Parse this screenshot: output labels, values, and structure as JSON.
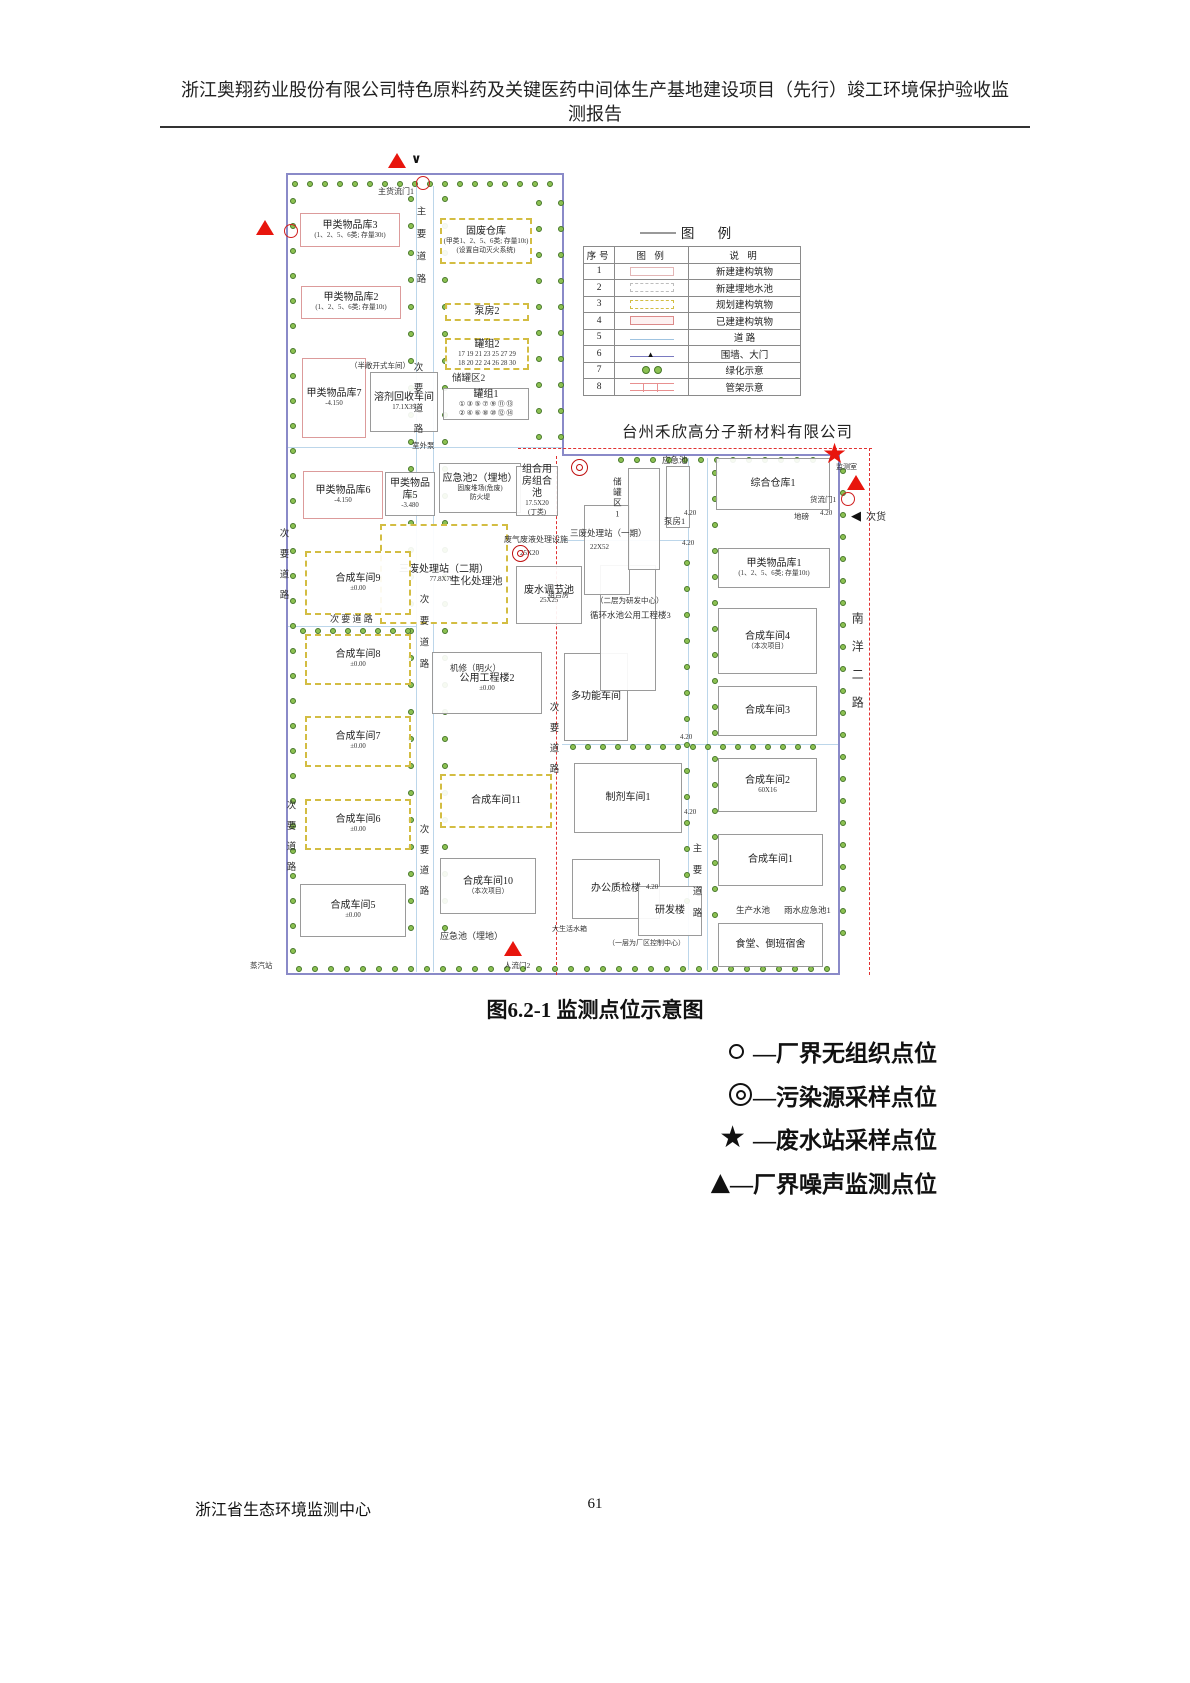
{
  "header": {
    "line1": "浙江奥翔药业股份有限公司特色原料药及关键医药中间体生产基地建设项目（先行）竣工环境保护验收监",
    "line2": "测报告"
  },
  "figure": {
    "caption": "图6.2-1  监测点位示意图"
  },
  "company_label": "台州禾欣高分子新材料有限公司",
  "legend_table": {
    "title": "图  例",
    "headers": [
      "序号",
      "图 例",
      "说 明"
    ],
    "rows": [
      {
        "no": "1",
        "symbol": "new-building",
        "desc": "新建建构筑物"
      },
      {
        "no": "2",
        "symbol": "new-pool",
        "desc": "新建埋地水池"
      },
      {
        "no": "3",
        "symbol": "planned",
        "desc": "规划建构筑物"
      },
      {
        "no": "4",
        "symbol": "existing",
        "desc": "已建建构筑物"
      },
      {
        "no": "5",
        "symbol": "road",
        "desc": "道  路"
      },
      {
        "no": "6",
        "symbol": "fence-gate",
        "desc": "围墙、大门"
      },
      {
        "no": "7",
        "symbol": "greenery",
        "desc": "绿化示意"
      },
      {
        "no": "8",
        "symbol": "pipe-rack",
        "desc": "管架示意"
      }
    ]
  },
  "point_legend": [
    {
      "symbol": "circle",
      "label": "—厂界无组织点位"
    },
    {
      "symbol": "double-circle",
      "label": "—污染源采样点位"
    },
    {
      "symbol": "star",
      "label": "—废水站采样点位"
    },
    {
      "symbol": "triangle",
      "label": "—厂界噪声监测点位"
    }
  ],
  "footer": {
    "org": "浙江省生态环境监测中心",
    "page": "61"
  },
  "map": {
    "buildings": [
      {
        "id": "jialei-wupinku-3",
        "name": "甲类物品库3",
        "sub": [
          "(1、2、5、6类; 存量30t)"
        ],
        "x": 300,
        "y": 213,
        "w": 100,
        "h": 34,
        "style": "red"
      },
      {
        "id": "gufei-cangku",
        "name": "固废仓库",
        "sub": [
          "(甲类1、2、5、6类; 存量10t)",
          "(设置自动灭火系统)"
        ],
        "x": 440,
        "y": 218,
        "w": 92,
        "h": 46,
        "style": "yellow"
      },
      {
        "id": "jialei-wupinku-2",
        "name": "甲类物品库2",
        "sub": [
          "(1、2、5、6类; 存量10t)"
        ],
        "x": 301,
        "y": 286,
        "w": 100,
        "h": 33,
        "style": "red"
      },
      {
        "id": "bengfang-2",
        "name": "泵房2",
        "sub": [],
        "x": 445,
        "y": 303,
        "w": 84,
        "h": 18,
        "style": "yellow"
      },
      {
        "id": "guanzu-2",
        "name": "罐组2",
        "sub": [
          "17 19 21 23 25 27 29",
          "18 20 22 24 26 28 30"
        ],
        "x": 445,
        "y": 338,
        "w": 84,
        "h": 32,
        "style": "yellow"
      },
      {
        "id": "guanzu-1",
        "name": "罐组1",
        "sub": [
          "① ③ ⑤ ⑦ ⑨ ⑪ ⑬",
          "② ④ ⑥ ⑧ ⑩ ⑫ ⑭"
        ],
        "x": 443,
        "y": 388,
        "w": 86,
        "h": 32,
        "style": "gray"
      },
      {
        "id": "jialei-wupinku-7",
        "name": "甲类物品库7",
        "sub": [
          "-4.150"
        ],
        "x": 302,
        "y": 358,
        "w": 64,
        "h": 80,
        "style": "red"
      },
      {
        "id": "rongji-huishou",
        "name": "溶剂回收车间",
        "sub": [
          "17.1X39"
        ],
        "x": 370,
        "y": 372,
        "w": 68,
        "h": 60,
        "style": "gray"
      },
      {
        "id": "yingjichi-2",
        "name": "应急池2（埋地）",
        "sub": [
          "固废堆场(危废)",
          "防火堤"
        ],
        "x": 439,
        "y": 463,
        "w": 82,
        "h": 50,
        "style": "gray"
      },
      {
        "id": "jialei-wupinku-5",
        "name": "甲类物品库5",
        "sub": [
          "-3.480"
        ],
        "x": 385,
        "y": 472,
        "w": 50,
        "h": 44,
        "style": "gray"
      },
      {
        "id": "jialei-wupinku-6",
        "name": "甲类物品库6",
        "sub": [
          "-4.150"
        ],
        "x": 303,
        "y": 471,
        "w": 80,
        "h": 48,
        "style": "red"
      },
      {
        "id": "zuhe-yongfang",
        "name": "组合用房组合池",
        "sub": [
          "17.5X20",
          "(丁类)"
        ],
        "x": 516,
        "y": 466,
        "w": 42,
        "h": 50,
        "style": "gray"
      },
      {
        "id": "sanfei-erqi",
        "name": "三废处理站（二期）",
        "sub": [
          "77.8X79.5"
        ],
        "x": 380,
        "y": 524,
        "w": 128,
        "h": 100,
        "style": "yellow"
      },
      {
        "id": "feishui-tiaojiechi",
        "name": "废水调节池",
        "sub": [
          "25X25"
        ],
        "x": 516,
        "y": 566,
        "w": 66,
        "h": 58,
        "style": "gray"
      },
      {
        "id": "hecheng-9",
        "name": "合成车间9",
        "sub": [
          "±0.00"
        ],
        "x": 305,
        "y": 551,
        "w": 106,
        "h": 64,
        "style": "yellow"
      },
      {
        "id": "hecheng-8",
        "name": "合成车间8",
        "sub": [
          "±0.00"
        ],
        "x": 305,
        "y": 634,
        "w": 106,
        "h": 51,
        "style": "yellow"
      },
      {
        "id": "gongyong-gongchenglou-2",
        "name": "公用工程楼2",
        "sub": [
          "±0.00"
        ],
        "x": 432,
        "y": 652,
        "w": 110,
        "h": 62,
        "style": "gray"
      },
      {
        "id": "hecheng-7",
        "name": "合成车间7",
        "sub": [
          "±0.00"
        ],
        "x": 305,
        "y": 716,
        "w": 106,
        "h": 51,
        "style": "yellow"
      },
      {
        "id": "hecheng-11",
        "name": "合成车间11",
        "sub": [],
        "x": 440,
        "y": 774,
        "w": 112,
        "h": 54,
        "style": "yellow"
      },
      {
        "id": "hecheng-6",
        "name": "合成车间6",
        "sub": [
          "±0.00"
        ],
        "x": 305,
        "y": 799,
        "w": 106,
        "h": 51,
        "style": "yellow"
      },
      {
        "id": "hecheng-5",
        "name": "合成车间5",
        "sub": [
          "±0.00"
        ],
        "x": 300,
        "y": 884,
        "w": 106,
        "h": 53,
        "style": "gray"
      },
      {
        "id": "hecheng-10",
        "name": "合成车间10",
        "sub": [
          "（本次项目）"
        ],
        "x": 440,
        "y": 858,
        "w": 96,
        "h": 56,
        "style": "gray"
      },
      {
        "id": "duogongneng",
        "name": "多功能车间",
        "sub": [],
        "x": 564,
        "y": 653,
        "w": 64,
        "h": 88,
        "style": "gray"
      },
      {
        "id": "gongyong-gongchenglou-3",
        "name": "",
        "sub": [],
        "x": 600,
        "y": 565,
        "w": 56,
        "h": 126,
        "style": "gray"
      },
      {
        "id": "sanfei-yiqi",
        "name": "",
        "sub": [],
        "x": 584,
        "y": 505,
        "w": 46,
        "h": 90,
        "style": "gray"
      },
      {
        "id": "chuguanqu-1",
        "name": "",
        "sub": [],
        "x": 628,
        "y": 468,
        "w": 32,
        "h": 102,
        "style": "gray"
      },
      {
        "id": "yingjichi-right",
        "name": "",
        "sub": [],
        "x": 666,
        "y": 466,
        "w": 24,
        "h": 62,
        "style": "gray"
      },
      {
        "id": "zonghe-cangku-1",
        "name": "综合仓库1",
        "sub": [],
        "x": 716,
        "y": 458,
        "w": 114,
        "h": 52,
        "style": "gray"
      },
      {
        "id": "jialei-wupinku-1",
        "name": "甲类物品库1",
        "sub": [
          "(1、2、5、6类; 存量10t)"
        ],
        "x": 718,
        "y": 548,
        "w": 112,
        "h": 40,
        "style": "gray"
      },
      {
        "id": "hecheng-4",
        "name": "合成车间4",
        "sub": [
          "（本次项目）"
        ],
        "x": 718,
        "y": 608,
        "w": 99,
        "h": 66,
        "style": "gray"
      },
      {
        "id": "hecheng-3",
        "name": "合成车间3",
        "sub": [],
        "x": 718,
        "y": 686,
        "w": 99,
        "h": 50,
        "style": "gray"
      },
      {
        "id": "hecheng-2",
        "name": "合成车间2",
        "sub": [
          "60X16"
        ],
        "x": 718,
        "y": 758,
        "w": 99,
        "h": 54,
        "style": "gray"
      },
      {
        "id": "hecheng-1",
        "name": "合成车间1",
        "sub": [],
        "x": 718,
        "y": 834,
        "w": 105,
        "h": 52,
        "style": "gray"
      },
      {
        "id": "zhiji-1",
        "name": "制剂车间1",
        "sub": [],
        "x": 574,
        "y": 763,
        "w": 108,
        "h": 70,
        "style": "gray"
      },
      {
        "id": "bangong-zhijianlou",
        "name": "办公质检楼",
        "sub": [],
        "x": 572,
        "y": 859,
        "w": 88,
        "h": 60,
        "style": "gray"
      },
      {
        "id": "yanfalou",
        "name": "研发楼",
        "sub": [],
        "x": 638,
        "y": 886,
        "w": 64,
        "h": 50,
        "style": "gray"
      },
      {
        "id": "shitang-sushe",
        "name": "食堂、倒班宿舍",
        "sub": [],
        "x": 718,
        "y": 923,
        "w": 105,
        "h": 44,
        "style": "gray"
      }
    ],
    "labels": [
      {
        "t": "主货流门1",
        "x": 378,
        "y": 188,
        "s": 8
      },
      {
        "t": "（半敞开式车间）",
        "x": 350,
        "y": 362,
        "s": 7.5
      },
      {
        "t": "室外泵",
        "x": 412,
        "y": 442,
        "s": 7.5
      },
      {
        "t": "储罐区2",
        "x": 452,
        "y": 374,
        "s": 9.5
      },
      {
        "t": "机修（明火）",
        "x": 450,
        "y": 664,
        "s": 8.5
      },
      {
        "t": "次 要 道 路",
        "x": 330,
        "y": 615,
        "s": 9
      },
      {
        "t": "应急池（埋地）",
        "x": 440,
        "y": 932,
        "s": 9
      },
      {
        "t": "蒸汽站",
        "x": 250,
        "y": 962,
        "s": 7.5
      },
      {
        "t": "人流门2",
        "x": 504,
        "y": 962,
        "s": 7.5
      },
      {
        "t": "大生活水箱",
        "x": 552,
        "y": 926,
        "s": 7
      },
      {
        "t": "（一层为厂区控制中心）",
        "x": 608,
        "y": 940,
        "s": 7
      },
      {
        "t": "废气废液处理设施",
        "x": 504,
        "y": 536,
        "s": 8
      },
      {
        "t": "25X20",
        "x": 520,
        "y": 550,
        "s": 7
      },
      {
        "t": "三废处理站（一期）",
        "x": 570,
        "y": 529,
        "s": 8.5
      },
      {
        "t": "22X52",
        "x": 590,
        "y": 544,
        "s": 7
      },
      {
        "t": "生化处理池",
        "x": 450,
        "y": 576,
        "s": 10.5
      },
      {
        "t": "（二层为研发中心）",
        "x": 596,
        "y": 597,
        "s": 7.5
      },
      {
        "t": "循环水池公用工程楼3",
        "x": 590,
        "y": 611,
        "s": 8.5
      },
      {
        "t": "组合房",
        "x": 548,
        "y": 592,
        "s": 7
      },
      {
        "t": "应急池",
        "x": 662,
        "y": 456,
        "s": 8.5
      },
      {
        "t": "泵房1",
        "x": 664,
        "y": 517,
        "s": 8.5
      },
      {
        "t": "监测室",
        "x": 836,
        "y": 464,
        "s": 7
      },
      {
        "t": "货流门1",
        "x": 810,
        "y": 496,
        "s": 7.5
      },
      {
        "t": "地磅",
        "x": 794,
        "y": 513,
        "s": 7.5
      },
      {
        "t": "次货",
        "x": 866,
        "y": 512,
        "s": 10
      },
      {
        "t": "生产水池",
        "x": 736,
        "y": 906,
        "s": 8.5
      },
      {
        "t": "雨水应急池1",
        "x": 784,
        "y": 906,
        "s": 8.5
      },
      {
        "t": "4.20",
        "x": 684,
        "y": 510,
        "s": 7
      },
      {
        "t": "4.20",
        "x": 820,
        "y": 510,
        "s": 7
      },
      {
        "t": "4.20",
        "x": 682,
        "y": 540,
        "s": 7
      },
      {
        "t": "4.20",
        "x": 680,
        "y": 734,
        "s": 7
      },
      {
        "t": "4.20",
        "x": 684,
        "y": 809,
        "s": 7
      },
      {
        "t": "4.20",
        "x": 646,
        "y": 884,
        "s": 7
      }
    ],
    "vlabels": [
      {
        "t": "主要道路",
        "x": 414,
        "y": 206,
        "s": 9.5,
        "ls": 13
      },
      {
        "t": "次要道路",
        "x": 411,
        "y": 362,
        "s": 9.5,
        "ls": 11
      },
      {
        "t": "次要道路",
        "x": 277,
        "y": 528,
        "s": 9.5,
        "ls": 11
      },
      {
        "t": "次要道路",
        "x": 417,
        "y": 594,
        "s": 9.5,
        "ls": 12
      },
      {
        "t": "次要道路",
        "x": 284,
        "y": 800,
        "s": 9.5,
        "ls": 11
      },
      {
        "t": "次要道路",
        "x": 417,
        "y": 824,
        "s": 9.5,
        "ls": 11
      },
      {
        "t": "次要道路",
        "x": 547,
        "y": 702,
        "s": 9.5,
        "ls": 11
      },
      {
        "t": "主要道路",
        "x": 690,
        "y": 843,
        "s": 9.5,
        "ls": 12
      },
      {
        "t": "南洋二路",
        "x": 850,
        "y": 612,
        "s": 12,
        "ls": 16
      },
      {
        "t": "储罐区1",
        "x": 612,
        "y": 477,
        "s": 8.5,
        "ls": 2
      }
    ],
    "markers": [
      {
        "type": "triangle",
        "x": 388,
        "y": 153
      },
      {
        "type": "check",
        "x": 411,
        "y": 153
      },
      {
        "type": "circle",
        "x": 416,
        "y": 176
      },
      {
        "type": "triangle",
        "x": 256,
        "y": 220
      },
      {
        "type": "circle",
        "x": 284,
        "y": 224
      },
      {
        "type": "double-circle",
        "x": 571,
        "y": 459
      },
      {
        "type": "double-circle",
        "x": 512,
        "y": 545
      },
      {
        "type": "star",
        "x": 822,
        "y": 440
      },
      {
        "type": "triangle",
        "x": 847,
        "y": 475
      },
      {
        "type": "circle",
        "x": 841,
        "y": 492
      },
      {
        "type": "arrow-left",
        "x": 851,
        "y": 510
      },
      {
        "type": "triangle",
        "x": 504,
        "y": 941
      }
    ]
  }
}
